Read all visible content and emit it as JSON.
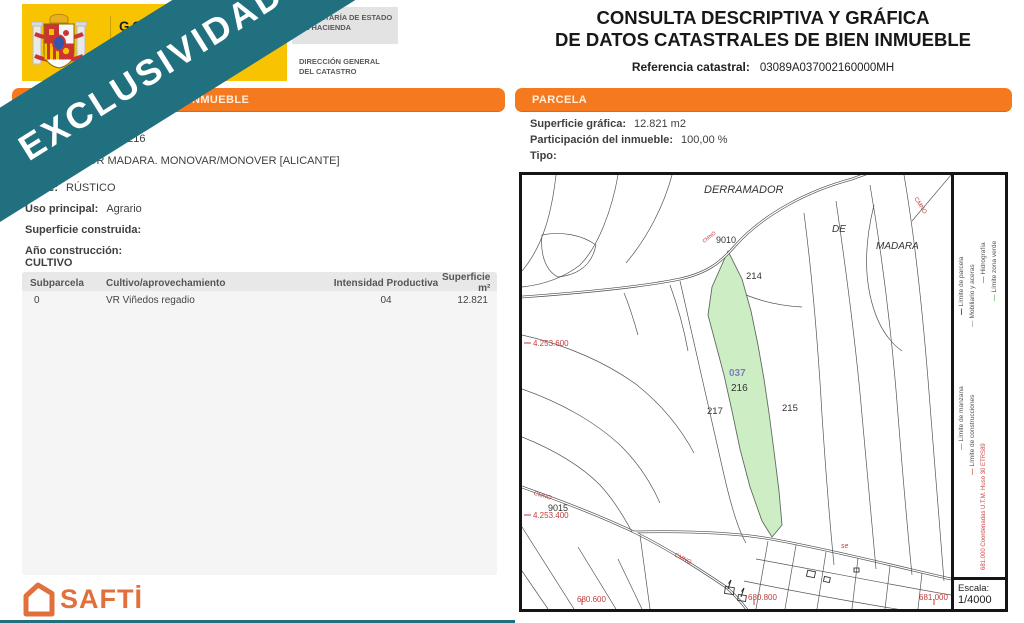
{
  "banner": {
    "text": "EXCLUSIVIDAD",
    "color": "#20707f"
  },
  "header": {
    "gobierno_line1": "GOBIERNO",
    "gobierno_line2": "DE ESPAÑA",
    "secretaria_line1": "SECRETARÍA DE ESTADO",
    "secretaria_line2": "DE HACIENDA",
    "direccion_line1": "DIRECCIÓN GENERAL",
    "direccion_line2": "DEL CATASTRO",
    "title_line1": "CONSULTA DESCRIPTIVA Y GRÁFICA",
    "title_line2": "DE DATOS CATASTRALES DE BIEN INMUEBLE",
    "ref_label": "Referencia catastral:",
    "ref_value": "03089A037002160000MH"
  },
  "left_panel": {
    "section_title": "DATOS DESCRIPTIVOS DEL INMUEBLE",
    "location_line1": "Polígono 37 Parcela 216",
    "location_line2": "DERRAMADOR MADARA. MONOVAR/MONOVER [ALICANTE]",
    "clase_label": "Clase:",
    "clase_value": "RÚSTICO",
    "uso_label": "Uso principal:",
    "uso_value": "Agrario",
    "superficie_label": "Superficie construida:",
    "anio_label": "Año construcción:",
    "cultivo_title": "CULTIVO",
    "table": {
      "headers": [
        "Subparcela",
        "Cultivo/aprovechamiento",
        "Intensidad Productiva",
        "Superficie m²"
      ],
      "rows": [
        [
          "0",
          "VR Viñedos regadio",
          "04",
          "12.821"
        ]
      ]
    }
  },
  "right_panel": {
    "section_title": "PARCELA",
    "superficie_label": "Superficie gráfica:",
    "superficie_value": "12.821 m2",
    "participacion_label": "Participación del inmueble:",
    "participacion_value": "100,00 %",
    "tipo_label": "Tipo:"
  },
  "map": {
    "place_line1": "DERRAMADOR",
    "place_line2": "DE",
    "place_line3": "MADARA",
    "parcel_214": "214",
    "parcel_215": "215",
    "parcel_216": "216",
    "parcel_217": "217",
    "subparcel_037": "037",
    "node_9010": "9010",
    "node_9015": "9015",
    "coord_y1": "4.253.600",
    "coord_y2": "4.253.400",
    "coord_x1": "680.600",
    "coord_x2": "680.800",
    "coord_x3": "681.000",
    "road_label": "CMNO",
    "se_label": "se",
    "utm_note": "681.000 Coordenadas U.T.M. Huso 30 ETRS89",
    "escala_label": "Escala:",
    "escala_value": "1/4000",
    "legend_dash": "—",
    "legend": [
      {
        "label": "Límite de parcela",
        "color": "#000000"
      },
      {
        "label": "Mobiliario y aceras",
        "color": "#9a9a9a"
      },
      {
        "label": "Hidrografía",
        "color": "#6565c8"
      },
      {
        "label": "Límite zona verde",
        "color": "#5aad5a"
      },
      {
        "label": "Límite de manzana",
        "color": "#9e5fb5"
      },
      {
        "label": "Límite de construcciones",
        "color": "#cb4747"
      }
    ],
    "highlight_fill": "#cdeec5"
  },
  "footer": {
    "brand": "SAFTİ",
    "brand_color": "#e2703c"
  },
  "colors": {
    "section_bar": "#f57a1f",
    "map_red": "#c23b3b",
    "banner_teal": "#20707f"
  }
}
